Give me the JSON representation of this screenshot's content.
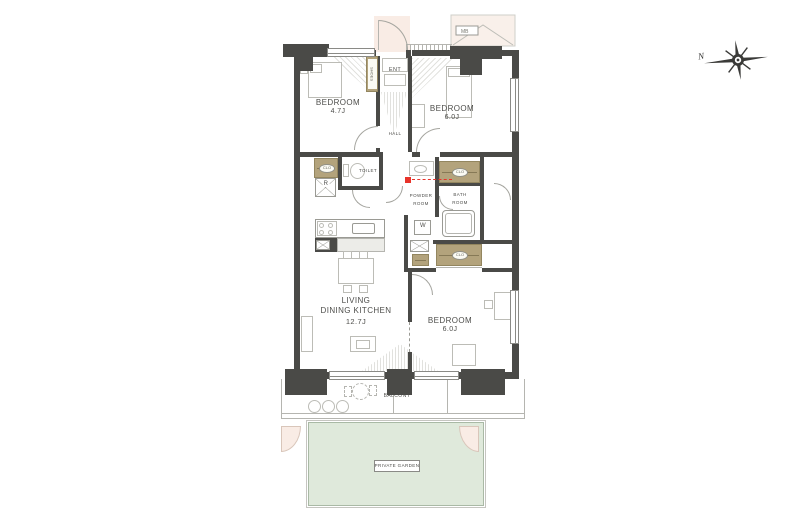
{
  "page": {
    "background": "#ffffff"
  },
  "colors": {
    "wall": "#4a4a47",
    "closet_tan": "#b3a37c",
    "garden_green": "#dfe9db",
    "entry_pink": "#f9ece5",
    "marker_red": "#e8332a"
  },
  "compass": {
    "north_label": "N"
  },
  "rooms": {
    "bedroom_top_left": {
      "name": "BEDROOM",
      "size": "4.7J"
    },
    "bedroom_top_right": {
      "name": "BEDROOM",
      "size": "6.0J"
    },
    "bedroom_bottom": {
      "name": "BEDROOM",
      "size": "6.0J"
    },
    "living_dining_kitchen": {
      "line1": "LIVING",
      "line2": "DINING KITCHEN",
      "size": "12.7J"
    },
    "entrance": {
      "label": "ENT"
    },
    "hall": {
      "label": "HALL"
    },
    "toilet": {
      "label": "TOILET"
    },
    "powder_room": {
      "line1": "POWDER",
      "line2": "ROOM"
    },
    "bath_room": {
      "line1": "BATH",
      "line2": "ROOM"
    },
    "balcony": {
      "label": "BALCONY"
    },
    "private_garden": {
      "label": "PRIVATE GARDEN"
    }
  },
  "fixtures": {
    "washer_label": "W",
    "refrigerator_label": "R",
    "shoe_cabinet_label": "SHOES",
    "closet_label": "CLO",
    "meter_box_label": "MB"
  }
}
